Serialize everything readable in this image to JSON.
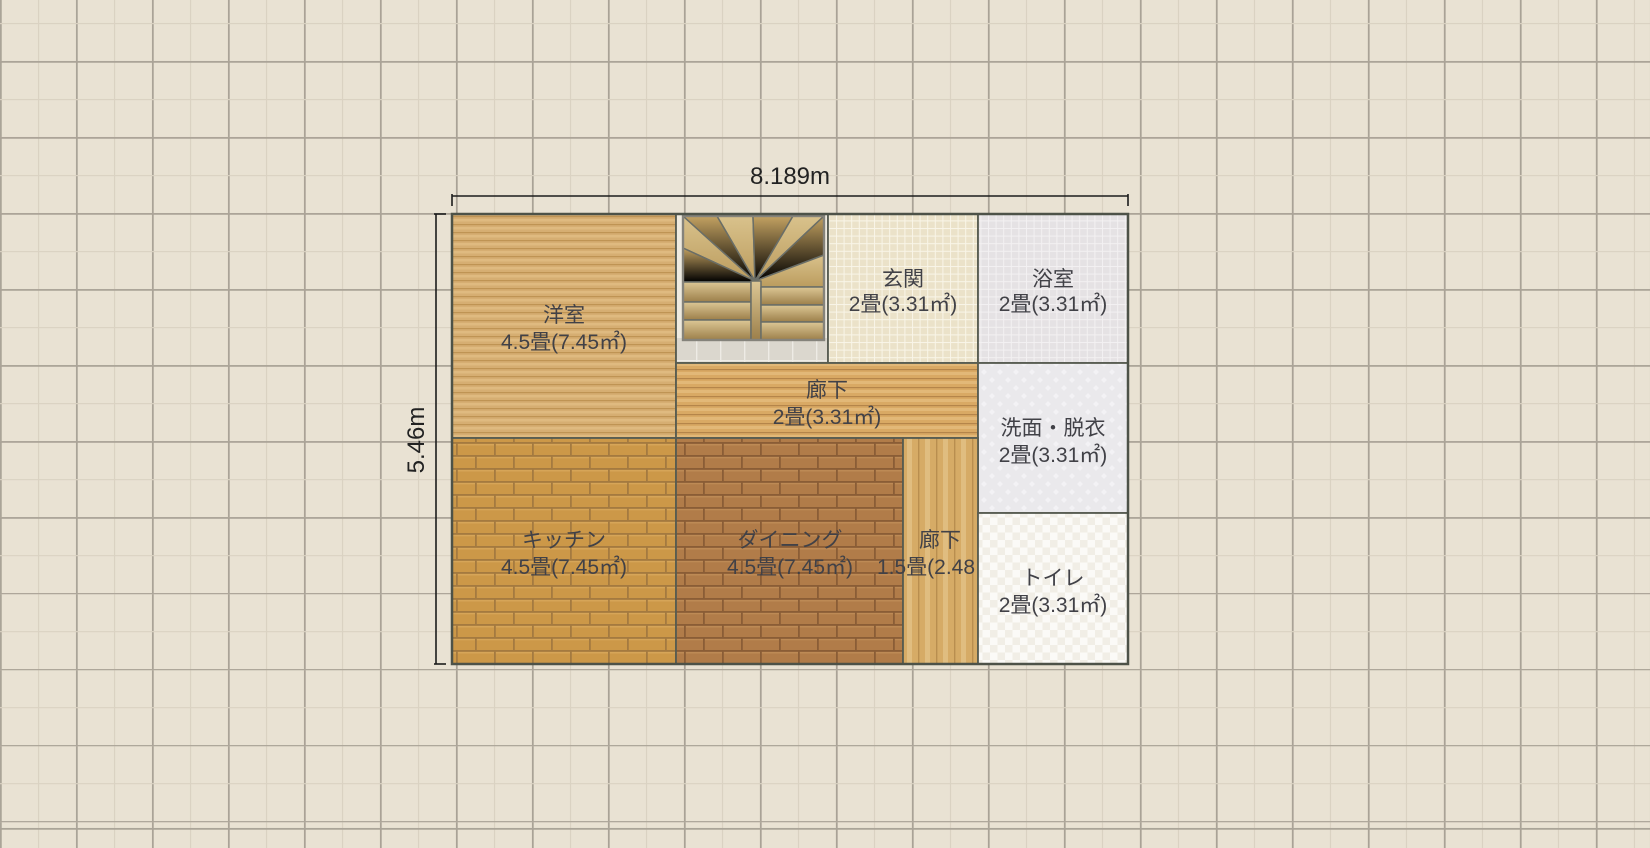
{
  "plan": {
    "width_label": "8.189m",
    "height_label": "5.46m",
    "rooms": [
      {
        "name": "洋室",
        "size": "4.5畳(7.45㎡)"
      },
      {
        "name": "玄関",
        "size": "2畳(3.31㎡)"
      },
      {
        "name": "浴室",
        "size": "2畳(3.31㎡)"
      },
      {
        "name": "廊下",
        "size": "2畳(3.31㎡)"
      },
      {
        "name": "洗面・脱衣",
        "size": "2畳(3.31㎡)"
      },
      {
        "name": "キッチン",
        "size": "4.5畳(7.45㎡)"
      },
      {
        "name": "ダイニング",
        "size": "4.5畳(7.45㎡)"
      },
      {
        "name": "廊下",
        "size": "1.5畳(2.48㎡)"
      },
      {
        "name": "トイレ",
        "size": "2畳(3.31㎡)"
      }
    ],
    "colors": {
      "canvas_bg": "#e9e2d3",
      "grid_major": "#a9a296",
      "grid_minor": "#dad2c2",
      "wall": "#575c51",
      "yoshitsu_wood": "#d6ae72",
      "hall_wood": "#d9a964",
      "hall2_wood": "#d6ab66",
      "kitchen_brick": "#cc9848",
      "dining_brick": "#b17c49",
      "genkan_tile": "#ebe2c9",
      "bath_tile": "#e5e2e4",
      "landing_tile": "#dbd7ce",
      "senmen_fill": "#eae9ec",
      "toilet_fill": "#fbfaf7",
      "dimension_line": "#1c1c1c"
    }
  }
}
